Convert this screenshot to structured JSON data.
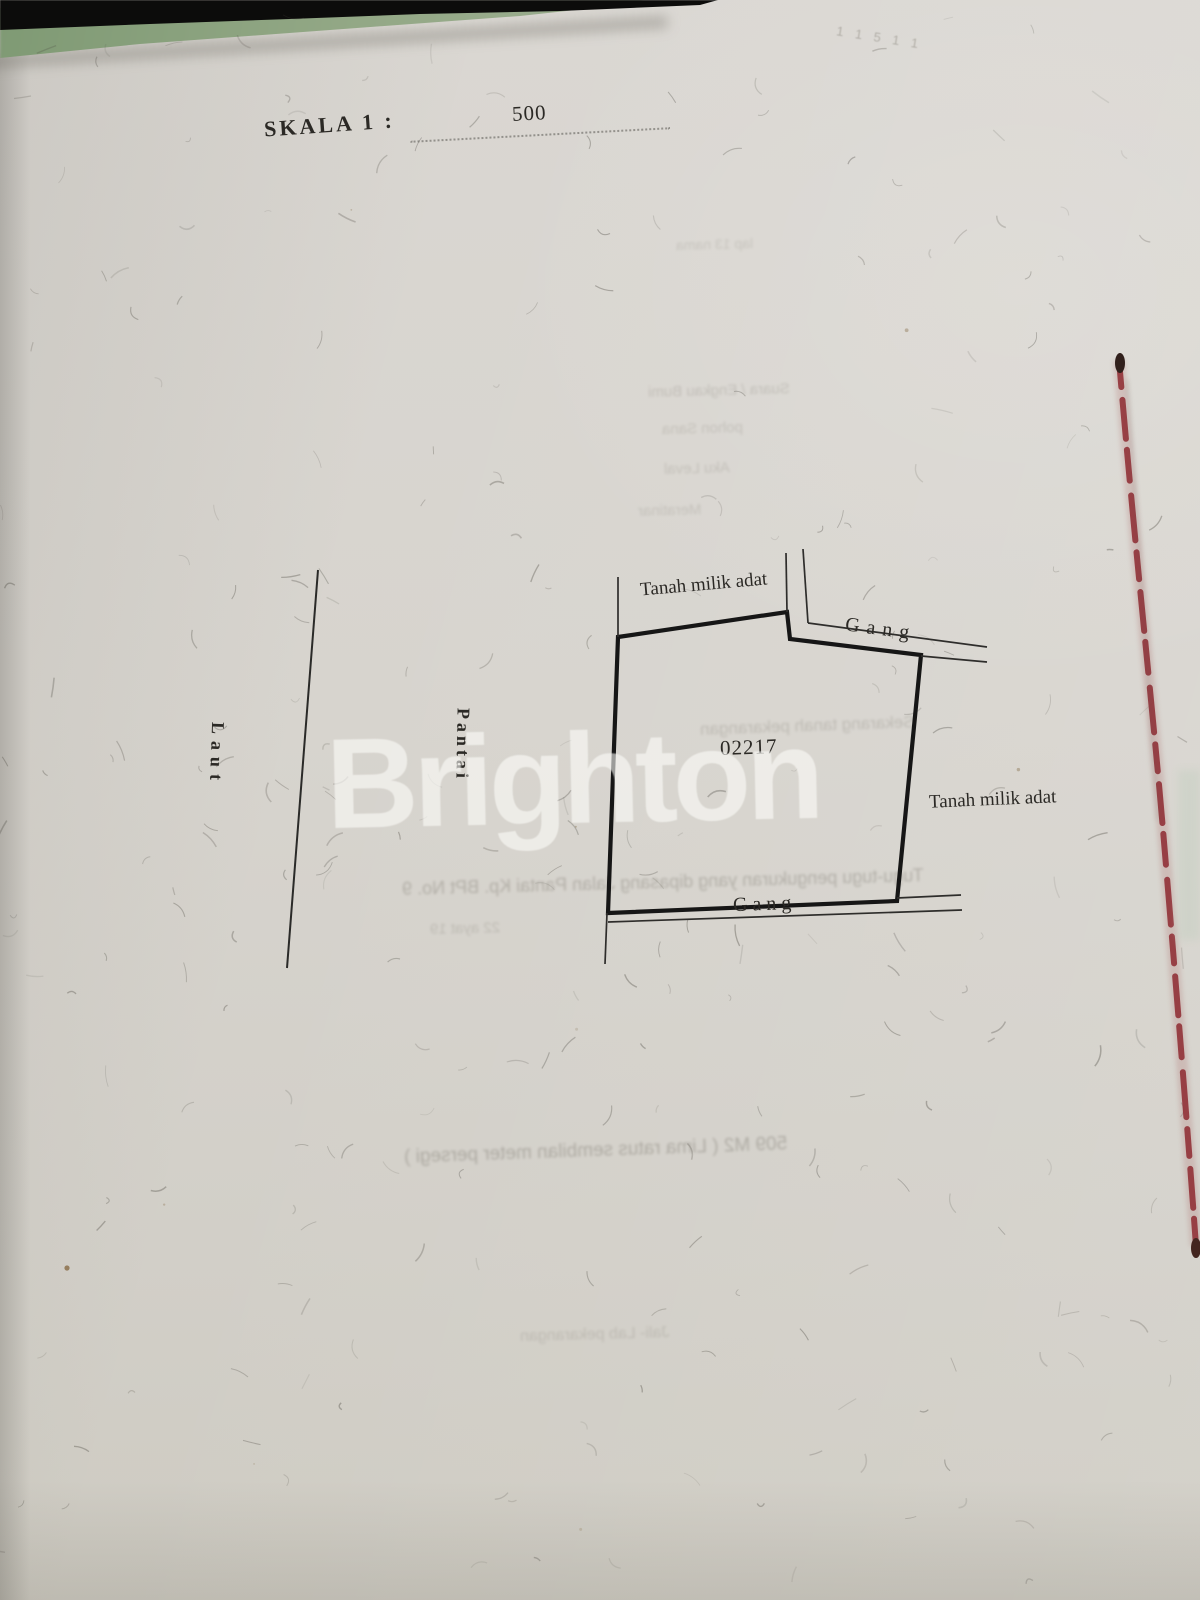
{
  "page": {
    "scale_label": "SKALA 1 :",
    "scale_value": "500",
    "watermark": "Brighton",
    "handwriting": "1 1 5 1 1"
  },
  "map": {
    "parcel_number": "02217",
    "label_top": "Tanah milik adat",
    "label_right": "Tanah milik adat",
    "alley_top": "Gang",
    "alley_bottom": "Gang",
    "sea_label": "Laut",
    "beach_label": "Pantai"
  },
  "ghost": {
    "top_fragment": "lap 13 nama",
    "col1": [
      "Suara / Engkau Bumi",
      "pohon Sana",
      "Aku Leval",
      "Meratinar"
    ],
    "line_mid": "Sekarang tanah pekarangan",
    "line_alley": "Tugu-tugu pengukuran yang dipasang Jalan Pantai Kp. BPt No. 9",
    "line_ayat": "22 ayat 19",
    "line_area": "509 M2 ( Lima ratus sembilan meter persegi )",
    "line_bottom": "Jali- Lab pekarangan"
  },
  "colors": {
    "paper": "#d7d4ce",
    "ink": "#1b1b1b",
    "binding_red": "#8f2d34",
    "cover_green": "#93a886",
    "watermark_white": "rgba(253,253,250,0.58)"
  }
}
